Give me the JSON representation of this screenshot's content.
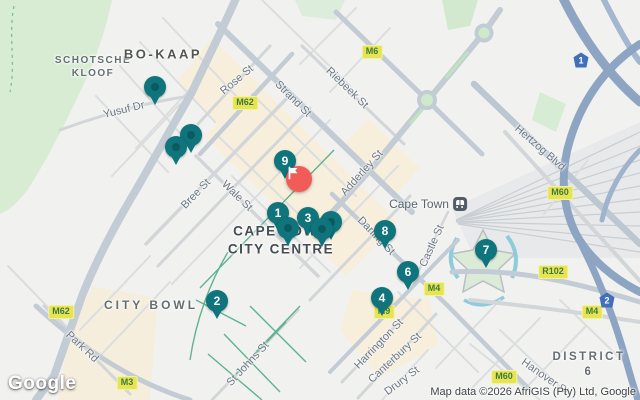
{
  "map": {
    "city": "Cape Town",
    "area_labels": [
      {
        "text": "SCHOTSCHE\nKLOOF",
        "style": "left:93px;top:67px;font-size:10px;letter-spacing:1.5px"
      },
      {
        "text": "BO-KAAP",
        "style": "left:163px;top:55px;font-size:13px;letter-spacing:2.5px;color:#53574e"
      },
      {
        "text": "CITY BOWL",
        "style": "left:151px;top:306px;font-size:12px;letter-spacing:3px"
      },
      {
        "text": "DISTRICT 6",
        "style": "left:589px;top:365px;font-size:11.5px;letter-spacing:2.5px"
      },
      {
        "text": "CAPE TOWN\nCITY CENTRE",
        "style": "left:281px;top:240px;font-size:13.5px;letter-spacing:1.5px;color:#454d51"
      }
    ],
    "street_labels": [
      {
        "text": "Yusuf Dr",
        "style": "left:124px;top:110px;transform:translate(-50%,-50%) rotate(-14deg)"
      },
      {
        "text": "Rose St",
        "style": "left:237px;top:80px;transform:translate(-50%,-50%) rotate(-40deg)"
      },
      {
        "text": "Strand St",
        "style": "left:293px;top:99px;transform:translate(-50%,-50%) rotate(45deg)"
      },
      {
        "text": "Riebeek St",
        "style": "left:347px;top:88px;transform:translate(-50%,-50%) rotate(44deg)"
      },
      {
        "text": "Adderley St",
        "style": "left:362px;top:173px;transform:translate(-50%,-50%) rotate(-48deg)"
      },
      {
        "text": "Bree St",
        "style": "left:196px;top:194px;transform:translate(-50%,-50%) rotate(-46deg)"
      },
      {
        "text": "Wale St",
        "style": "left:237px;top:196px;transform:translate(-50%,-50%) rotate(44deg)"
      },
      {
        "text": "Hertzog Blvd",
        "style": "left:540px;top:148px;transform:translate(-50%,-50%) rotate(41deg)"
      },
      {
        "text": "Darling St",
        "style": "left:376px;top:236px;transform:translate(-50%,-50%) rotate(46deg)"
      },
      {
        "text": "Castle St",
        "style": "left:432px;top:246px;transform:translate(-50%,-50%) rotate(-66deg)"
      },
      {
        "text": "Park Rd",
        "style": "left:82px;top:347px;transform:translate(-50%,-50%) rotate(43deg)"
      },
      {
        "text": "St Johns St",
        "style": "left:248px;top:364px;transform:translate(-50%,-50%) rotate(-47deg)"
      },
      {
        "text": "Harrington St",
        "style": "left:379px;top:344px;transform:translate(-50%,-50%) rotate(-46deg)"
      },
      {
        "text": "Canterbury St",
        "style": "left:395px;top:358px;transform:translate(-50%,-50%) rotate(-43deg)"
      },
      {
        "text": "Drury St",
        "style": "left:402px;top:381px;transform:translate(-50%,-50%) rotate(-37deg)"
      },
      {
        "text": "Hanover St",
        "style": "left:545px;top:377px;transform:translate(-50%,-50%) rotate(35deg)"
      }
    ],
    "route_badges": [
      {
        "text": "M6",
        "style": "left:372px;top:52px"
      },
      {
        "text": "M62",
        "style": "left:245px;top:103px"
      },
      {
        "text": "M62",
        "style": "left:61px;top:312px"
      },
      {
        "text": "M3",
        "style": "left:127px;top:383px"
      },
      {
        "text": "M60",
        "style": "left:560px;top:193px"
      },
      {
        "text": "M60",
        "style": "left:504px;top:377px"
      },
      {
        "text": "M4",
        "style": "left:434px;top:289px"
      },
      {
        "text": "M4",
        "style": "left:592px;top:312px"
      },
      {
        "text": "R102",
        "style": "left:553px;top:272px"
      },
      {
        "text": "M9",
        "style": "left:384px;top:312px"
      }
    ],
    "national_shields": [
      {
        "text": "1",
        "style": "left:581px;top:60px"
      },
      {
        "text": "2",
        "style": "left:607px;top:300px"
      }
    ],
    "station": {
      "name": "Cape Town",
      "style": "left:428px;top:204px"
    },
    "markers": {
      "numbered": [
        {
          "label": "9",
          "style": "left:285px;top:161px"
        },
        {
          "label": "8",
          "style": "left:385px;top:231px"
        },
        {
          "label": "6",
          "style": "left:408px;top:272px"
        },
        {
          "label": "4",
          "style": "left:382px;top:298px"
        },
        {
          "label": "2",
          "style": "left:217px;top:301px"
        },
        {
          "label": "7",
          "style": "left:486px;top:250px"
        },
        {
          "label": "1",
          "style": "left:278px;top:213px"
        },
        {
          "label": "3",
          "style": "left:308px;top:218px"
        }
      ],
      "plain": [
        {
          "style": "left:155px;top:87px"
        },
        {
          "style": "left:191px;top:135px"
        },
        {
          "style": "left:176px;top:147px"
        },
        {
          "style": "left:331px;top:222px"
        },
        {
          "style": "left:322px;top:229px"
        },
        {
          "style": "left:288px;top:228px"
        }
      ],
      "start": {
        "icon": "flag",
        "style": "left:299px;top:179px"
      }
    },
    "footer": {
      "logo": "Google",
      "attribution": "Map data ©2026 AfriGIS (Pty) Ltd, Google"
    },
    "colors": {
      "marker_teal": "#0f747c",
      "marker_dot": "#0b5a61",
      "start_red": "#f25c58",
      "badge_bg": "#e7e454",
      "badge_text": "#3c7a3f",
      "shield_blue": "#4170b8",
      "park_green": "#d7ecd3",
      "commercial_beige": "#f7efdc",
      "road_grey": "#c6ced6",
      "highway_blue": "#8da5c3"
    }
  }
}
